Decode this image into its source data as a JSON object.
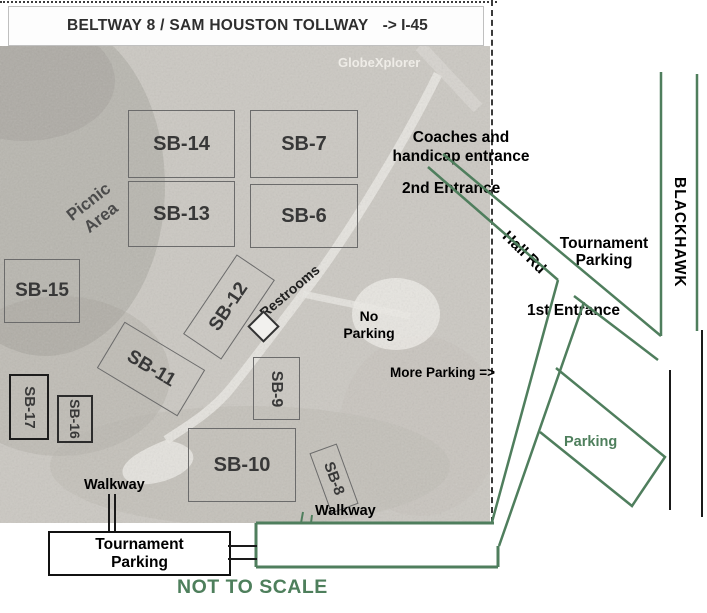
{
  "banner": {
    "road": "BELTWAY 8 / SAM HOUSTON TOLLWAY",
    "direction": "-> I-45"
  },
  "watermark": "GlobeXplorer",
  "fields": {
    "sb6": {
      "label": "SB-6"
    },
    "sb7": {
      "label": "SB-7"
    },
    "sb8": {
      "label": "SB-8"
    },
    "sb9": {
      "label": "SB-9"
    },
    "sb10": {
      "label": "SB-10"
    },
    "sb11": {
      "label": "SB-11"
    },
    "sb12": {
      "label": "SB-12"
    },
    "sb13": {
      "label": "SB-13"
    },
    "sb14": {
      "label": "SB-14"
    },
    "sb15": {
      "label": "SB-15"
    },
    "sb16": {
      "label": "SB-16"
    },
    "sb17": {
      "label": "SB-17"
    }
  },
  "photo_labels": {
    "picnic_line1": "Picnic",
    "picnic_line2": "Area",
    "restrooms": "Restrooms",
    "no_parking_line1": "No",
    "no_parking_line2": "Parking",
    "more_parking": "More Parking =>"
  },
  "annotations": {
    "coaches_line1": "Coaches and",
    "coaches_line2": "handicap entrance",
    "second_entrance": "2nd Entrance",
    "hall_rd": "Hall Rd",
    "tournament_right_line1": "Tournament",
    "tournament_right_line2": "Parking",
    "first_entrance": "1st Entrance",
    "blackhawk": "BLACKHAWK",
    "parking_area": "Parking",
    "walkway_left": "Walkway",
    "walkway_right": "Walkway",
    "box_left_line1": "Tournament",
    "box_left_line2": "Parking",
    "box_bottom_line1": "Tournament",
    "box_bottom_line2": "Parking",
    "not_to_scale": "NOT TO SCALE"
  },
  "colors": {
    "road_green": "#4f7e5d",
    "note_green": "#4e7f5c",
    "road_black": "#1a1a1a"
  }
}
